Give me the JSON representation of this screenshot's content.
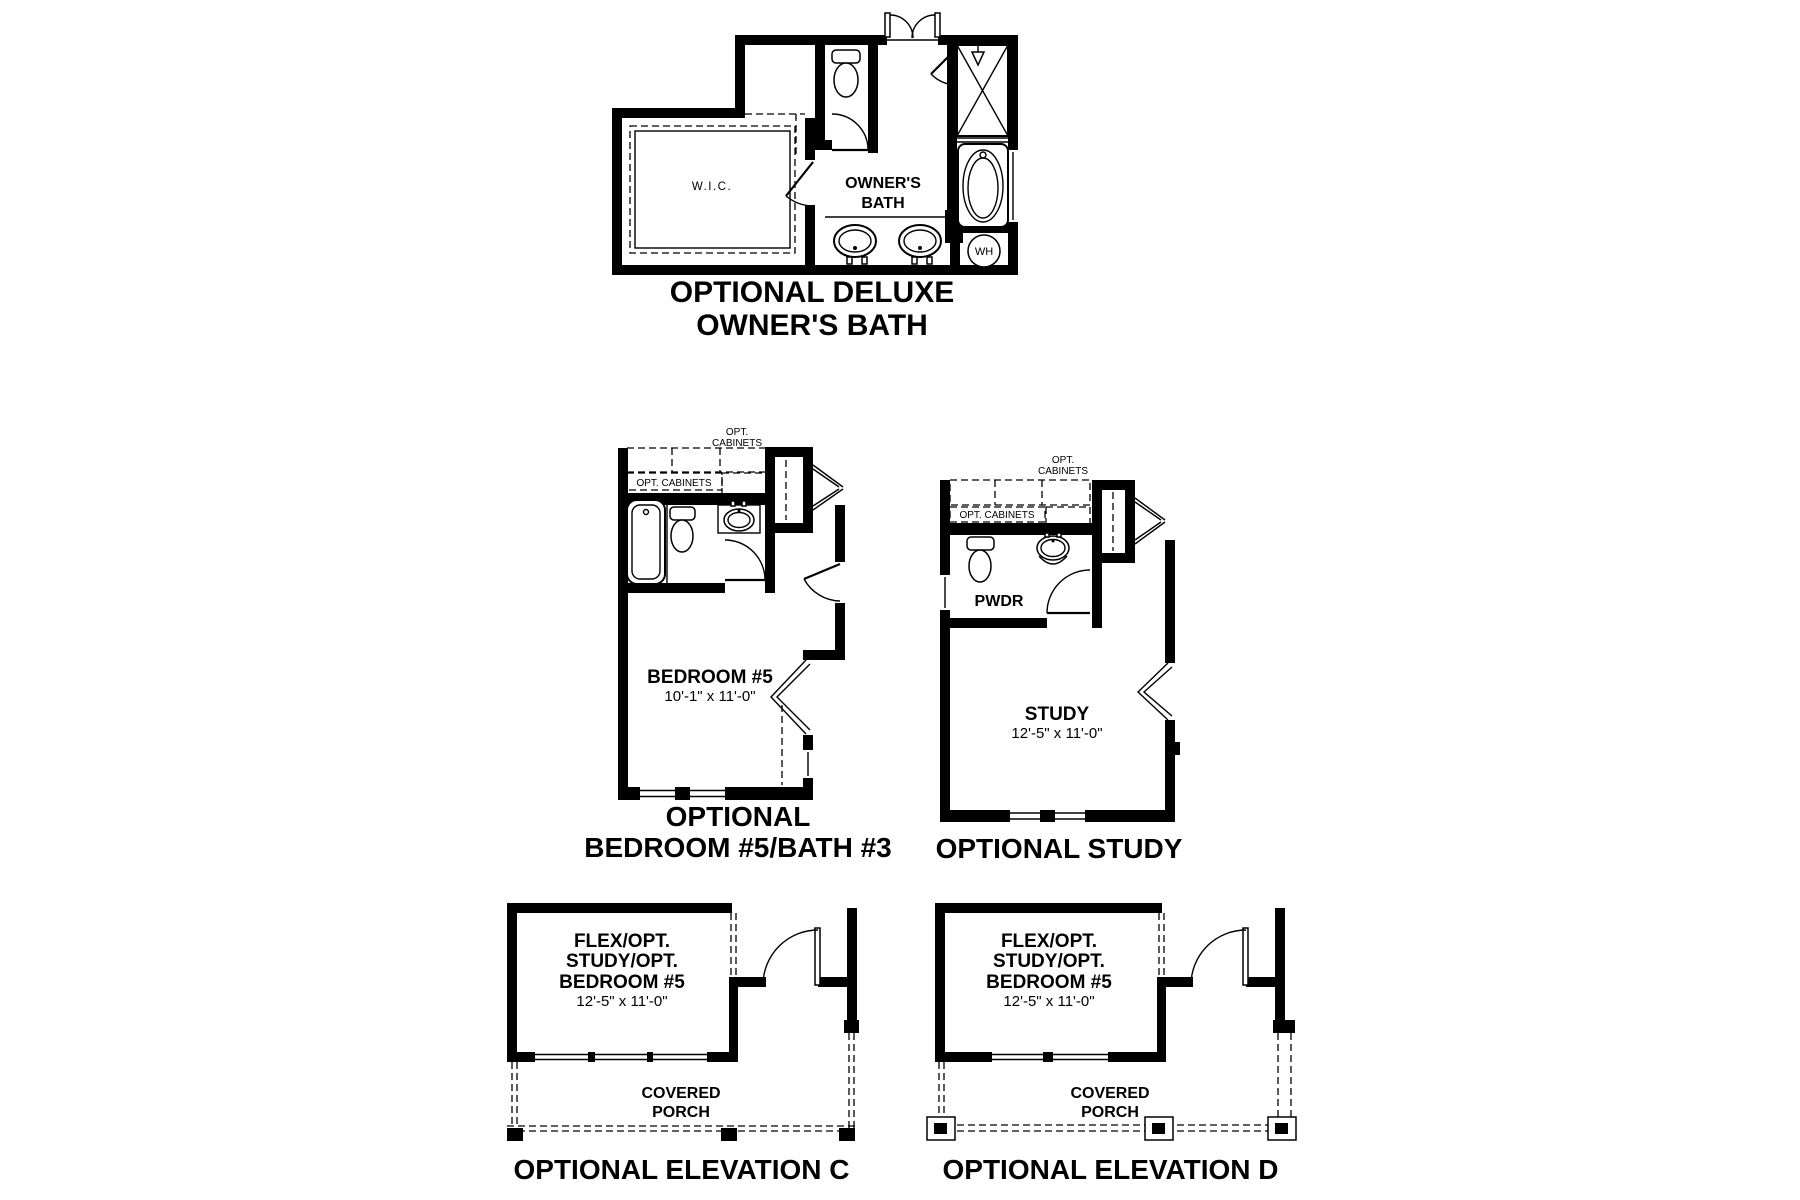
{
  "page": {
    "background": "#ffffff",
    "ink": "#000000"
  },
  "plans": {
    "deluxe_owners_bath": {
      "caption_line1": "OPTIONAL DELUXE",
      "caption_line2": "OWNER'S BATH",
      "wic_label": "W.I.C.",
      "room_line1": "OWNER'S",
      "room_line2": "BATH",
      "water_heater_label": "WH"
    },
    "bedroom5_bath3": {
      "caption_line1": "OPTIONAL",
      "caption_line2": "BEDROOM #5/BATH #3",
      "opt_cabinets_line1": "OPT.",
      "opt_cabinets_line2": "CABINETS",
      "opt_cabinets_inline": "OPT. CABINETS",
      "room_label": "BEDROOM #5",
      "room_dims": "10'-1\" x 11'-0\""
    },
    "study": {
      "caption": "OPTIONAL STUDY",
      "opt_cabinets_line1": "OPT.",
      "opt_cabinets_line2": "CABINETS",
      "opt_cabinets_inline": "OPT. CABINETS",
      "pwdr_label": "PWDR",
      "room_label": "STUDY",
      "room_dims": "12'-5\" x 11'-0\""
    },
    "elevation_c": {
      "caption": "OPTIONAL ELEVATION C",
      "room_line1": "FLEX/OPT.",
      "room_line2": "STUDY/OPT.",
      "room_line3": "BEDROOM #5",
      "room_dims": "12'-5\" x 11'-0\"",
      "porch_line1": "COVERED",
      "porch_line2": "PORCH"
    },
    "elevation_d": {
      "caption": "OPTIONAL ELEVATION D",
      "room_line1": "FLEX/OPT.",
      "room_line2": "STUDY/OPT.",
      "room_line3": "BEDROOM #5",
      "room_dims": "12'-5\" x 11'-0\"",
      "porch_line1": "COVERED",
      "porch_line2": "PORCH"
    }
  }
}
